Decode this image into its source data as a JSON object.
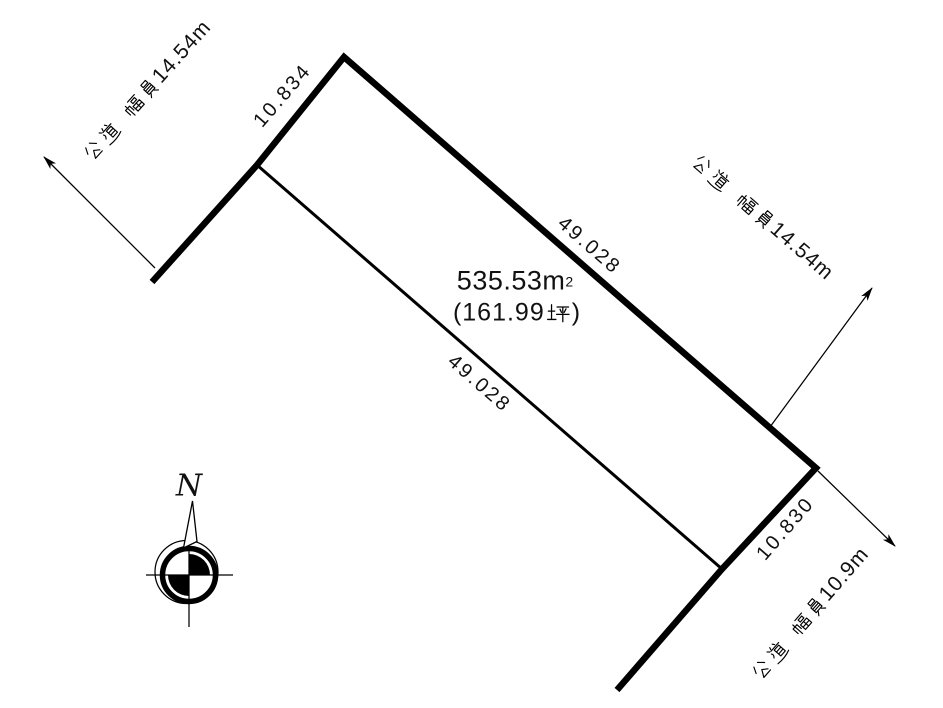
{
  "page": {
    "background": "#ffffff",
    "ink": "#000000"
  },
  "plot": {
    "area": {
      "display": "535.53㎡",
      "value": "535.53",
      "unit_base": "m",
      "unit_exp": "2",
      "tsubo_display": "（161.99坪）",
      "tsubo_open": "(",
      "tsubo_value": "161.99",
      "tsubo_unit": "坪",
      "tsubo_close": ")"
    },
    "edges": {
      "top_left": "10.834",
      "top_right": "49.028",
      "bottom_left": "49.028",
      "bottom_right": "10.830"
    }
  },
  "roads": {
    "upper_left": {
      "label": "公道 幅員14.54m",
      "type_word": "公道",
      "width_word": "幅員",
      "value": "14.54m"
    },
    "right": {
      "label": "公道 幅員14.54m",
      "type_word": "公道",
      "width_word": "幅員",
      "value": "14.54m"
    },
    "lower_right": {
      "label": "公道 幅員10.9m",
      "type_word": "公道",
      "width_word": "幅員",
      "value": "10.9m"
    }
  },
  "compass": {
    "north_label": "N"
  }
}
